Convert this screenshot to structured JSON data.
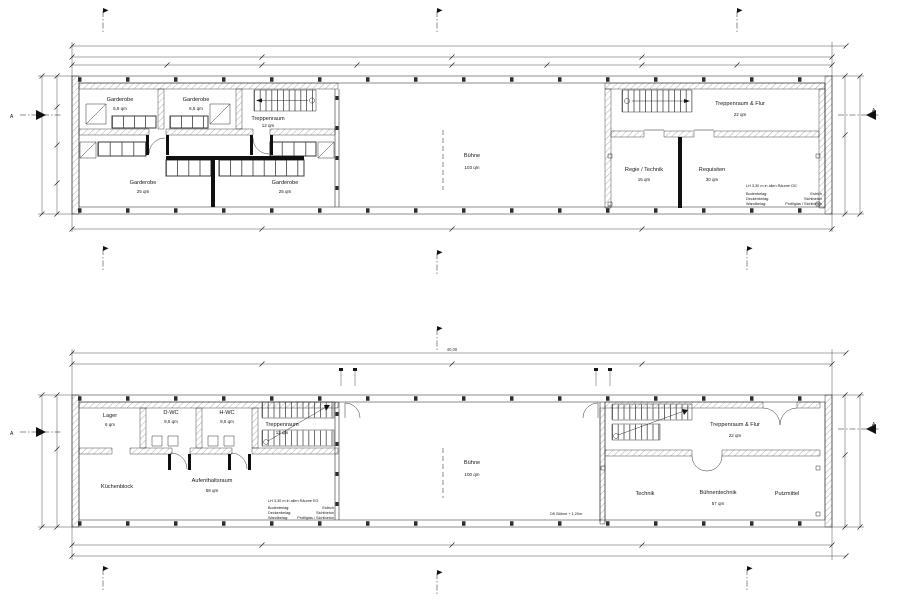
{
  "meta": {
    "background": "#ffffff",
    "ink": "#1c1c1c"
  },
  "plans": {
    "og": {
      "rooms": {
        "garderobe_a": {
          "name": "Garderobe",
          "area": "6,5 qm"
        },
        "garderobe_b": {
          "name": "Garderobe",
          "area": "6,5 qm"
        },
        "treppenraum": {
          "name": "Treppenraum",
          "area": "12 qm"
        },
        "garderobe_c": {
          "name": "Garderobe",
          "area": "25 qm"
        },
        "garderobe_d": {
          "name": "Garderobe",
          "area": "25 qm"
        },
        "buehne": {
          "name": "Bühne",
          "area": "103 qm"
        },
        "treppenraum_flur": {
          "name": "Treppenraum & Flur",
          "area": "22 qm"
        },
        "regie_technik": {
          "name": "Regie / Technik",
          "area": "15 qm"
        },
        "requisiten": {
          "name": "Requisiten",
          "area": "30 qm"
        }
      },
      "note": {
        "clear_height": "LH 3,30 m in allen Räume OG",
        "floor_label": "Bodenbelag:",
        "floor_value": "Estrich",
        "ceiling_label": "Deckenbelag:",
        "ceiling_value": "Sichtbeton",
        "wall_label": "Wandbelag:",
        "wall_value": "Profilglas / Sichtbeton"
      },
      "section_marker": "A"
    },
    "eg": {
      "rooms": {
        "lager": {
          "name": "Lager",
          "area": "6 qm"
        },
        "d_wc": {
          "name": "D-WC",
          "area": "9,5 qm"
        },
        "h_wc": {
          "name": "H-WC",
          "area": "9,5 qm"
        },
        "treppenraum": {
          "name": "Treppenraum",
          "area": "12 qm"
        },
        "kuechenblock": {
          "name": "Küchenblock"
        },
        "aufenthaltsraum": {
          "name": "Aufenthaltsraum",
          "area": "58 qm"
        },
        "buehne": {
          "name": "Bühne",
          "area": "100 qm"
        },
        "treppenraum_flur": {
          "name": "Treppenraum & Flur",
          "area": "22 qm"
        },
        "technik": {
          "name": "Technik"
        },
        "buehnentechnik": {
          "name": "Bühnentechnik",
          "area": "57 qm"
        },
        "putzmittel": {
          "name": "Putzmittel"
        }
      },
      "note": {
        "clear_height": "LH 3,30 m in allen Räume EG",
        "floor_label": "Bodenbelag:",
        "floor_value": "Estrich",
        "ceiling_label": "Deckenbelag:",
        "ceiling_value": "Sichtbeton",
        "wall_label": "Wandbelag:",
        "wall_value": "Profilglas / Sichtbeton"
      },
      "stage_level_note": "OK Bühne + 1,20m",
      "section_marker": "A"
    }
  },
  "dimensions": {
    "overall_length": "40,00"
  }
}
